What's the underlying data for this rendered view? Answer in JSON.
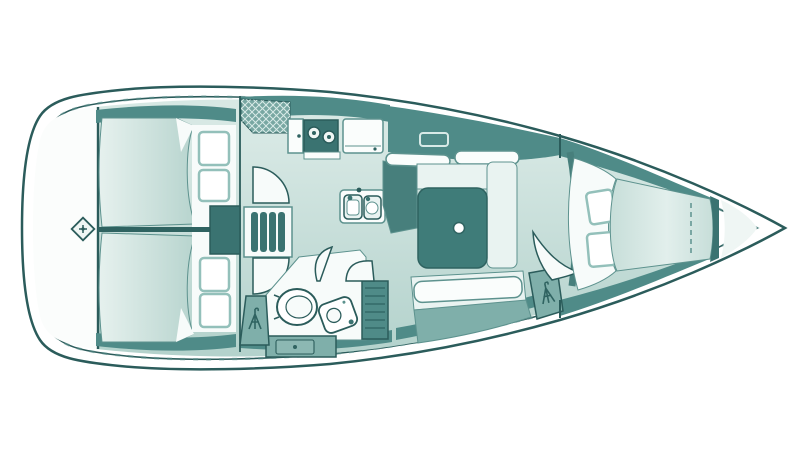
{
  "diagram": {
    "kind": "sailboat-interior-floor-plan",
    "view": "top-down deck plan, bow pointing right",
    "components": {
      "hull-outline": "hull and deck edge",
      "stern-locker": "transom / lazarette area",
      "steering-post-icon": "rudder post symbol",
      "aft-cabin-port": "aft double berth (upper)",
      "aft-cabin-starboard": "aft double berth (lower)",
      "engine-box": "engine compartment under steps",
      "companionway-steps": "companionway ladder",
      "galley-hatch-locker": "cross-hatched locker at companionway",
      "galley-cabinet": "galley cabinet",
      "stove": "two-burner stove",
      "refrigerator": "refrigerator / counter",
      "sink-unit": "double galley sink",
      "head-room": "head (bathroom)",
      "toilet": "marine toilet",
      "washbasin": "head washbasin",
      "louver-locker": "louvered wet locker",
      "vanity-drawer": "drawer unit",
      "hanging-locker-aft": "hanging locker with garment icon",
      "hanging-locker-forward": "hanging locker with garment icon",
      "salon-table": "salon table",
      "mast-post": "mast compression post",
      "dinette": "U-shaped dinette settee",
      "settee-starboard": "straight settee",
      "overhead-hatch-icon": "deck hatch outline",
      "forward-cabin": "V-berth owner cabin",
      "berth-seam": "dashed mattress seam",
      "anchor-locker": "bow anchor locker",
      "garment-icon": "hanging-clothes symbol"
    }
  },
  "colors": {
    "hull_white": "#ffffff",
    "stern_white": "#fbfdfc",
    "outline": "#2b5c5b",
    "outline_soft": "#5d928e",
    "band": "#4f8b88",
    "furn_mid": "#7fafaa",
    "furn_dark": "#477f7c",
    "block": "#3a7371",
    "table": "#3f7c79",
    "unit_white": "#fafdfc",
    "cushion": "#e9f3f1",
    "floor_a": "#d7e8e4",
    "floor_b": "#b3d2cc",
    "berth_a": "#e6f1ee",
    "berth_b": "#b7d4ce",
    "vberth_a": "#e2efec",
    "vberth_b": "#c7ded9",
    "pillow": "#ffffff",
    "pillow_stroke": "#93c0ba",
    "white_zone": "#f7fbfa",
    "near_white": "#eff6f4",
    "divider": "#2f6361",
    "hatch_base": "#78a7a2",
    "hatch_line": "#d8eae7"
  }
}
